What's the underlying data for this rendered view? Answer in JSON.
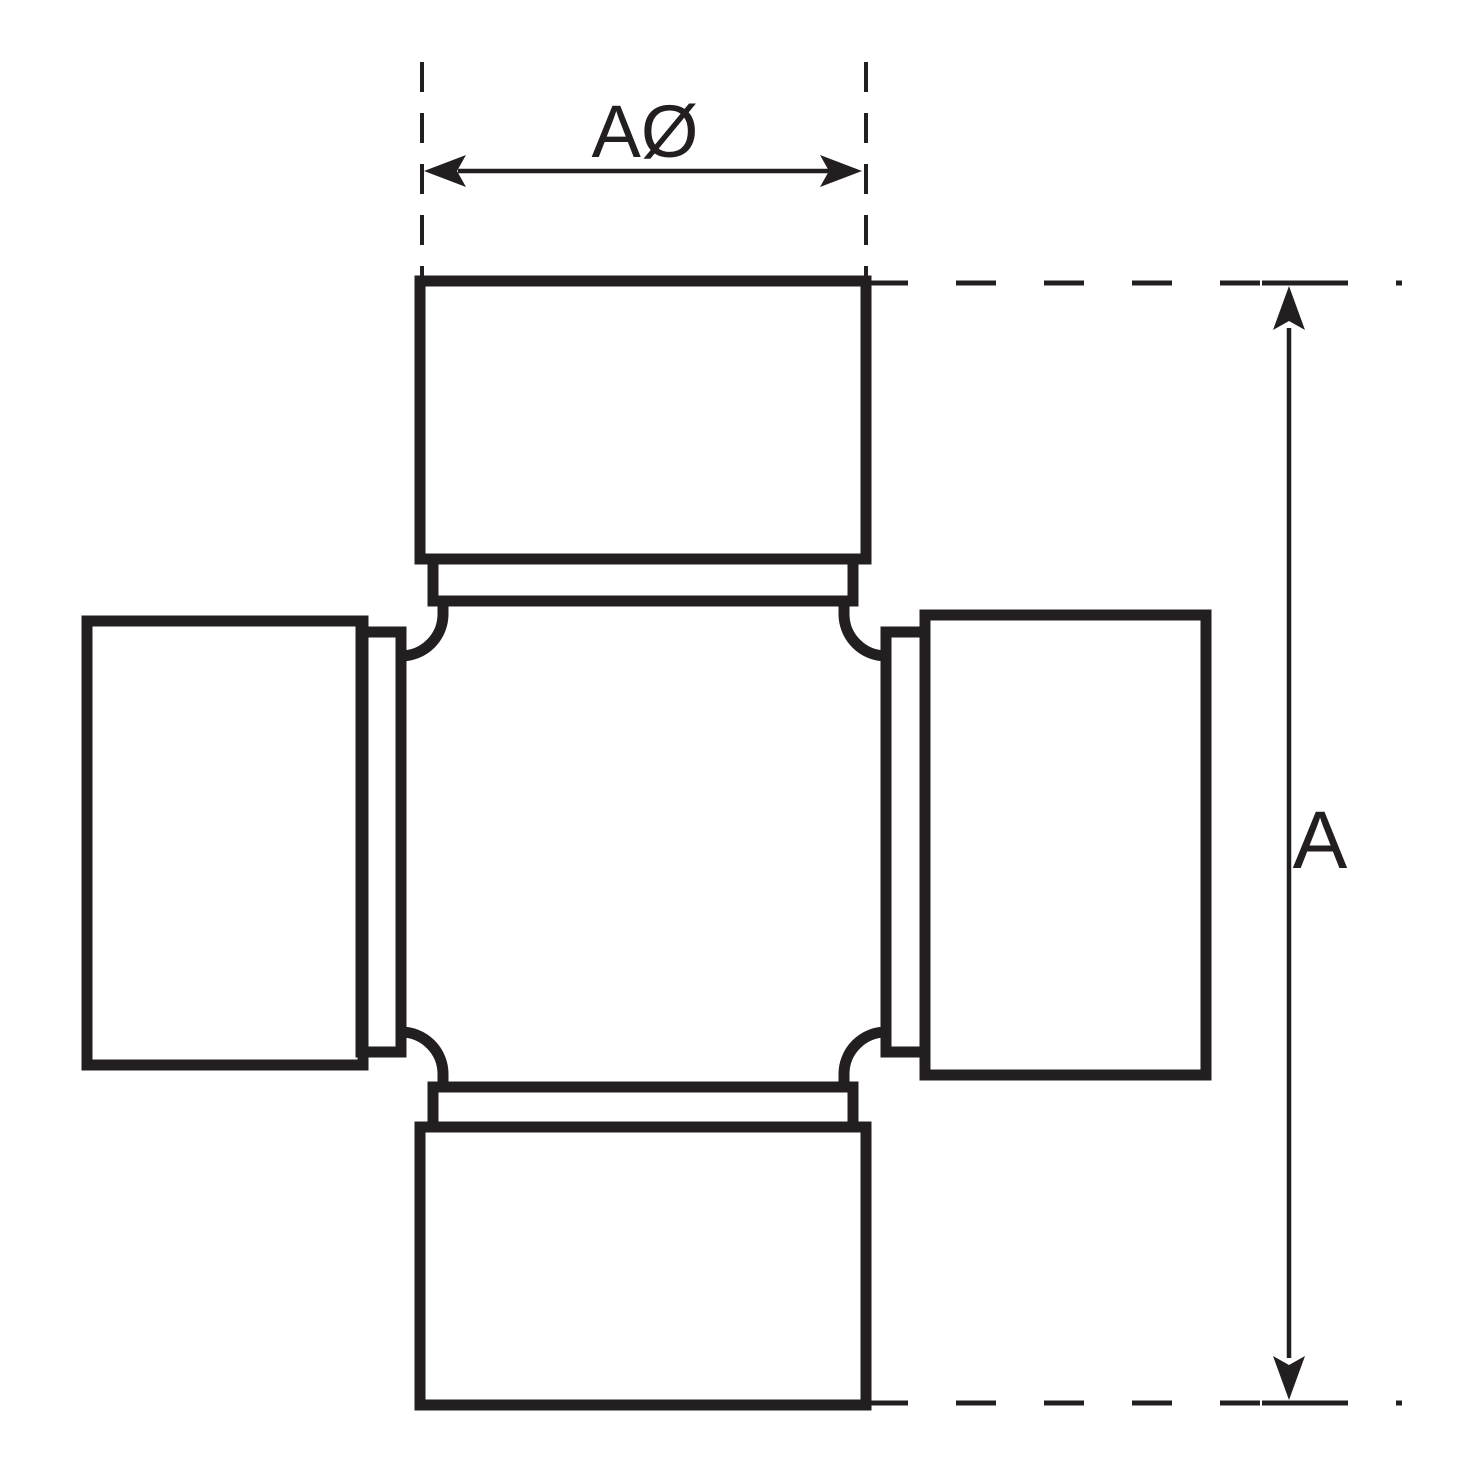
{
  "drawing": {
    "type": "technical-line-drawing",
    "subject": "universal-joint-cross",
    "colors": {
      "ink": "#231f20",
      "paper": "#ffffff"
    },
    "labels": {
      "cap_diameter": "AØ",
      "overall_length": "A"
    }
  }
}
